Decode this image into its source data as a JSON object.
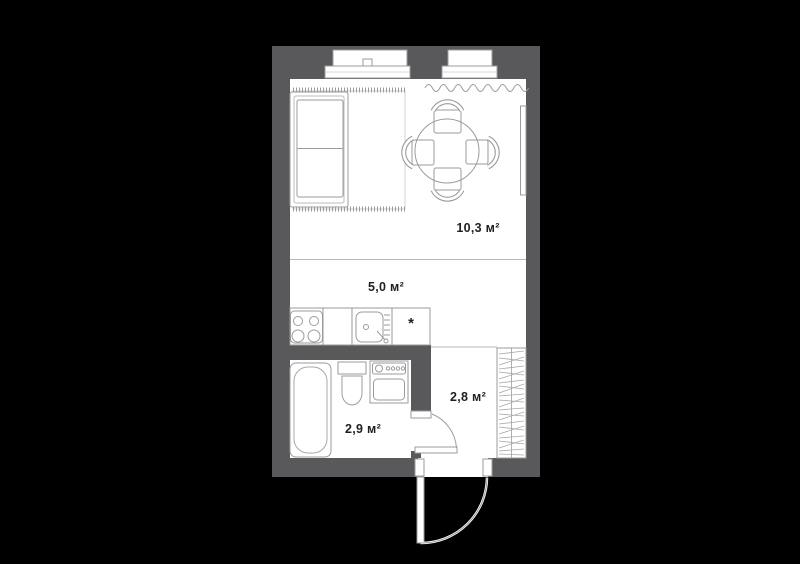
{
  "plan": {
    "type": "studio apartment floor plan",
    "colors": {
      "background": "#000000",
      "wall": "#59595b",
      "floor": "#ffffff",
      "furniture_line": "#9b9b9b",
      "divider_line": "#b8b8b8",
      "label_text": "#1f1f1f"
    },
    "rooms": {
      "living": {
        "area_label": "10,3 м²"
      },
      "kitchen": {
        "area_label": "5,0 м²",
        "counter_mark": "*"
      },
      "bathroom": {
        "area_label": "2,9 м²"
      },
      "hallway": {
        "area_label": "2,8 м²"
      }
    }
  }
}
